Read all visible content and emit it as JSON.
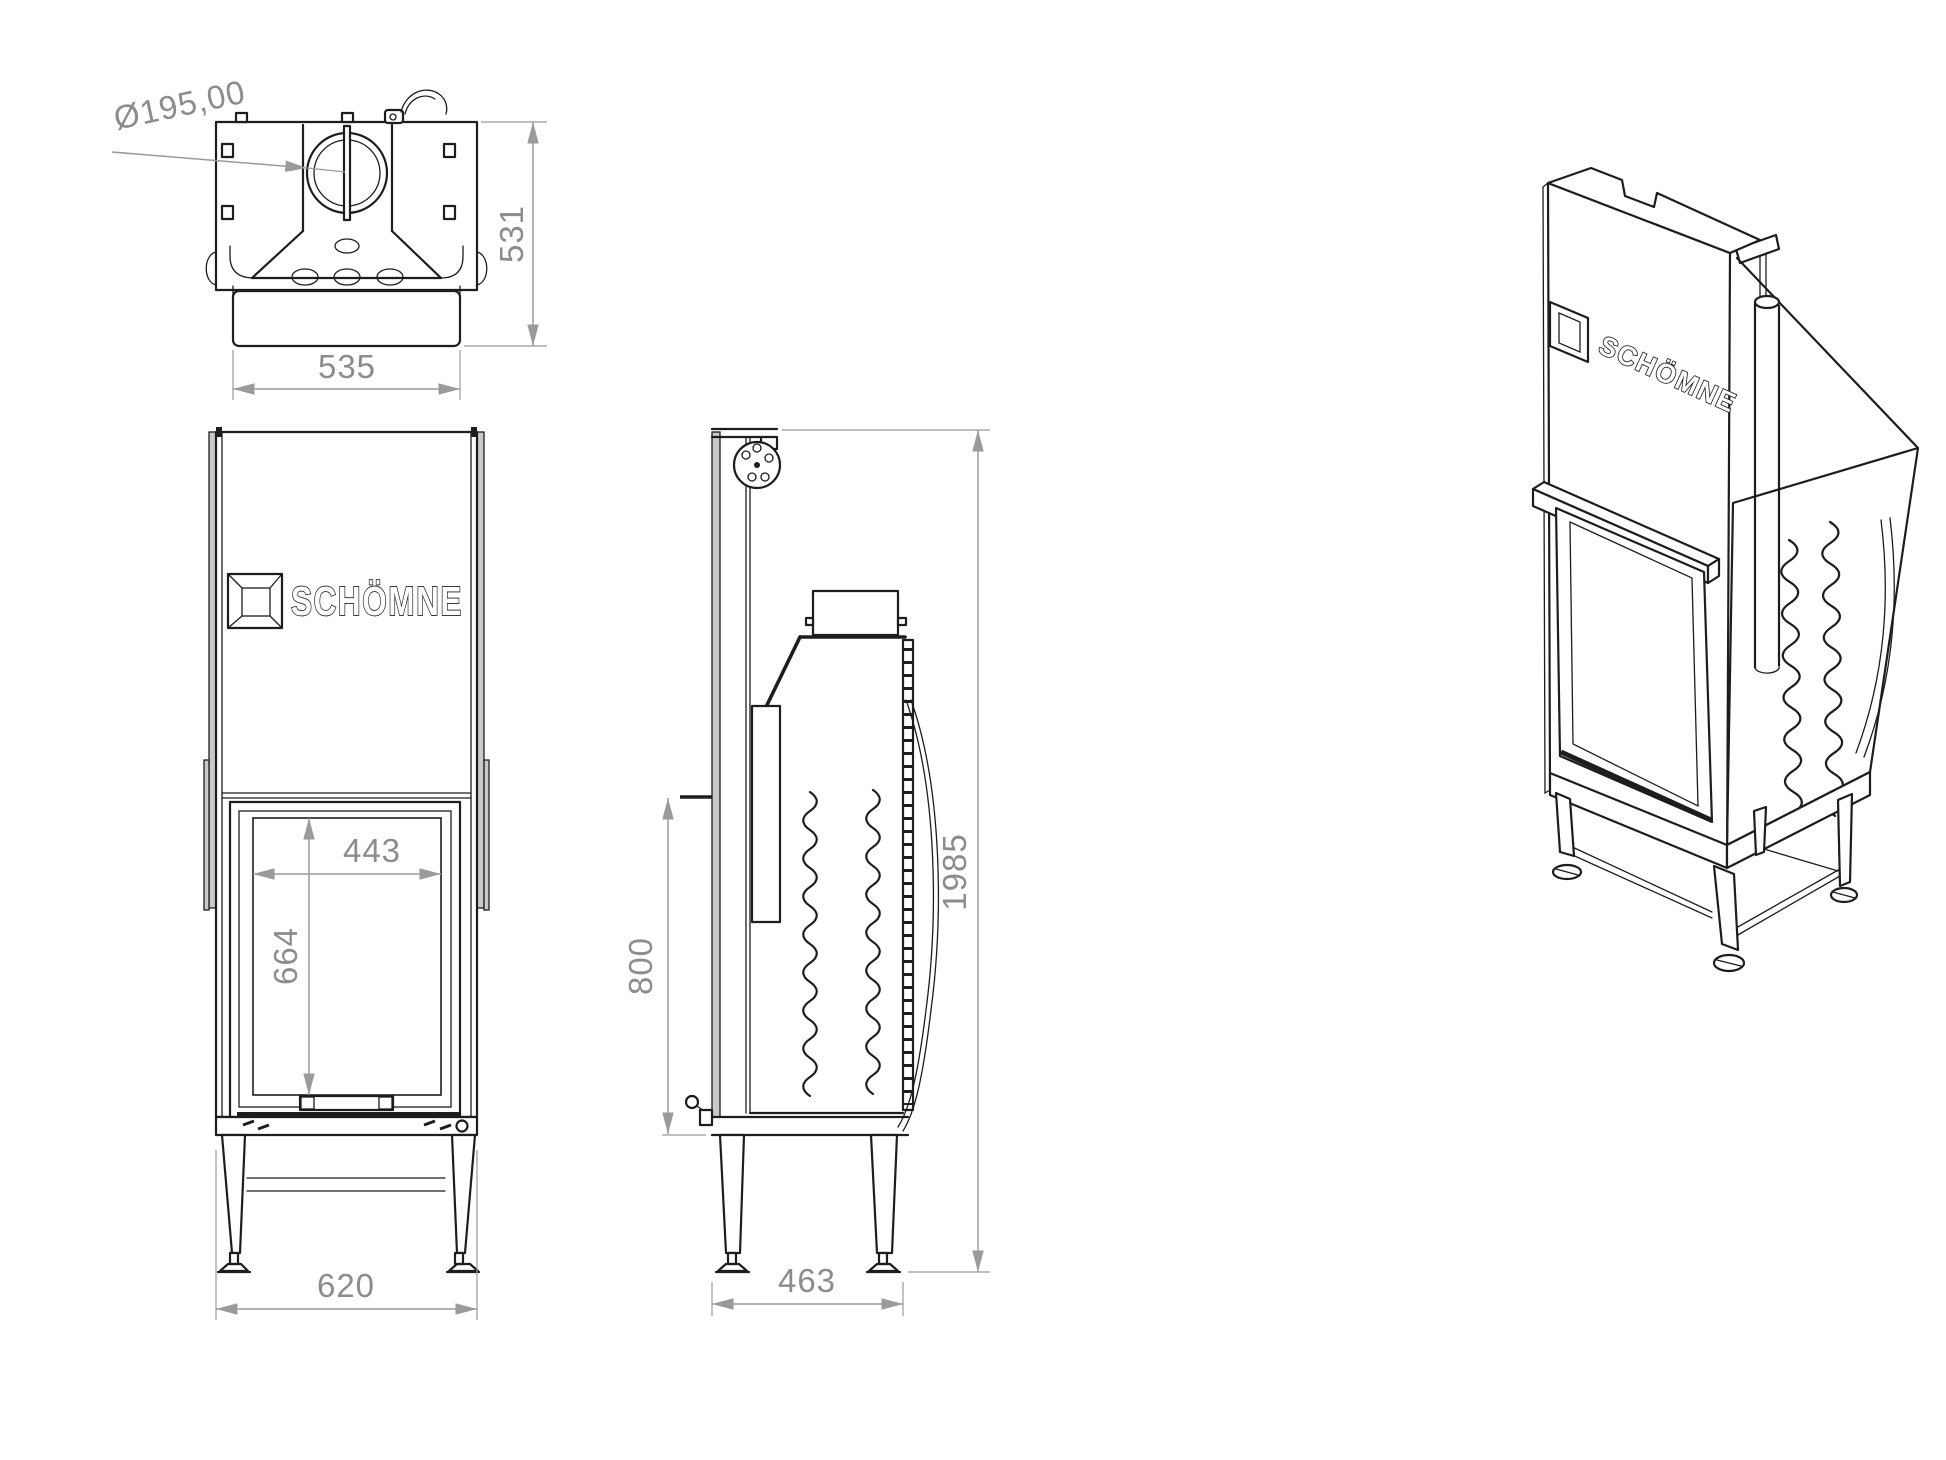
{
  "brand": {
    "name": "SCHÖMNE"
  },
  "dimensions": {
    "flue_diameter": "Ø195,00",
    "top_view_height": "531",
    "top_view_width": "535",
    "glass_width": "443",
    "glass_height": "664",
    "front_width": "620",
    "base_height": "800",
    "total_height": "1985",
    "depth": "463"
  },
  "colors": {
    "line": "#1d1d1d",
    "dimension_gray": "#8c8c8c",
    "shade_gray": "#c9c9c9",
    "background": "#ffffff"
  }
}
